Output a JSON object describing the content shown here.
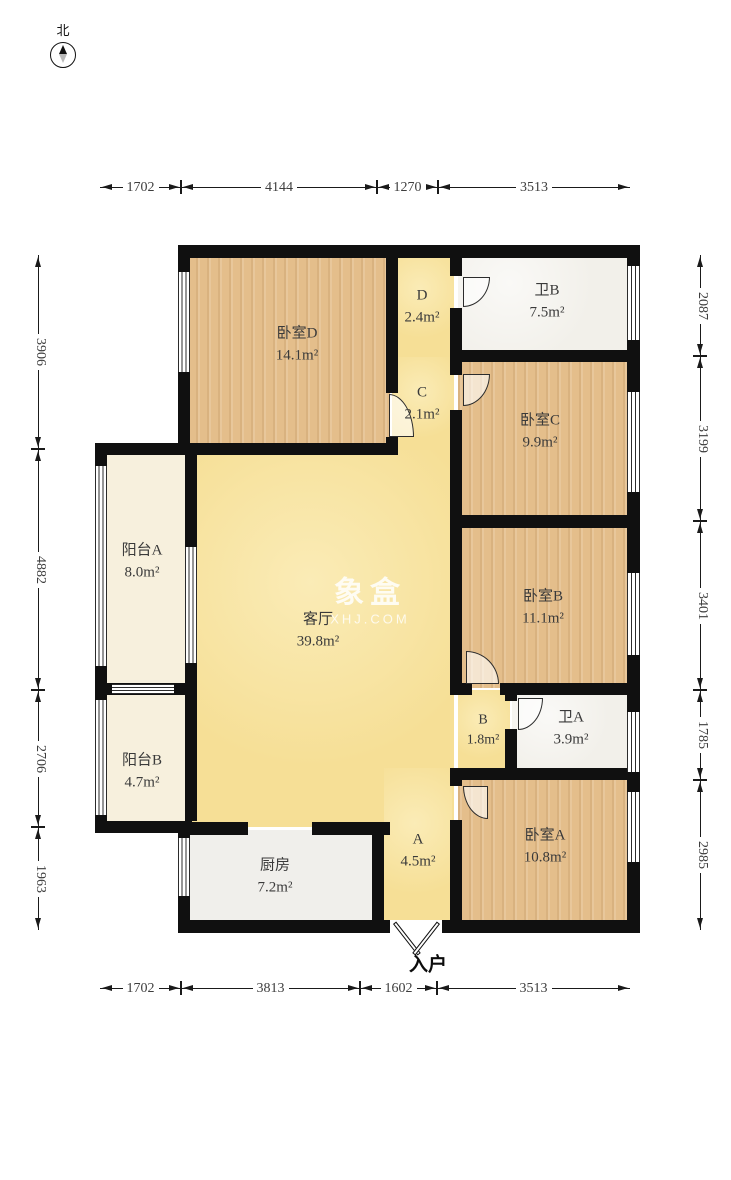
{
  "compass": {
    "label": "北"
  },
  "entry": {
    "label": "入户"
  },
  "watermark": {
    "title": "象盒",
    "subtitle": "XHJ.COM"
  },
  "rooms": {
    "bedroom_d": {
      "name": "卧室D",
      "area": "14.1m²"
    },
    "hall_d": {
      "name": "D",
      "area": "2.4m²"
    },
    "bath_b": {
      "name": "卫B",
      "area": "7.5m²"
    },
    "hall_c": {
      "name": "C",
      "area": "2.1m²"
    },
    "bedroom_c": {
      "name": "卧室C",
      "area": "9.9m²"
    },
    "balcony_a": {
      "name": "阳台A",
      "area": "8.0m²"
    },
    "living": {
      "name": "客厅",
      "area": "39.8m²"
    },
    "bedroom_b": {
      "name": "卧室B",
      "area": "11.1m²"
    },
    "balcony_b": {
      "name": "阳台B",
      "area": "4.7m²"
    },
    "hall_b": {
      "name": "B",
      "area": "1.8m²"
    },
    "bath_a": {
      "name": "卫A",
      "area": "3.9m²"
    },
    "kitchen": {
      "name": "厨房",
      "area": "7.2m²"
    },
    "hall_a": {
      "name": "A",
      "area": "4.5m²"
    },
    "bedroom_a": {
      "name": "卧室A",
      "area": "10.8m²"
    }
  },
  "dims": {
    "top": [
      "1702",
      "4144",
      "1270",
      "3513"
    ],
    "bottom": [
      "1702",
      "3813",
      "1602",
      "3513"
    ],
    "left": [
      "3906",
      "4882",
      "2706",
      "1963"
    ],
    "right": [
      "2087",
      "3199",
      "3401",
      "1785",
      "2985"
    ]
  },
  "colors": {
    "wall": "#101010",
    "living_yellow": "#f6df96",
    "bedroom_wood": "#e4be8b",
    "balcony_cream": "#f7f0dd",
    "bath_tile": "#f2f0ea",
    "kitchen_gray": "#f0efeb"
  }
}
